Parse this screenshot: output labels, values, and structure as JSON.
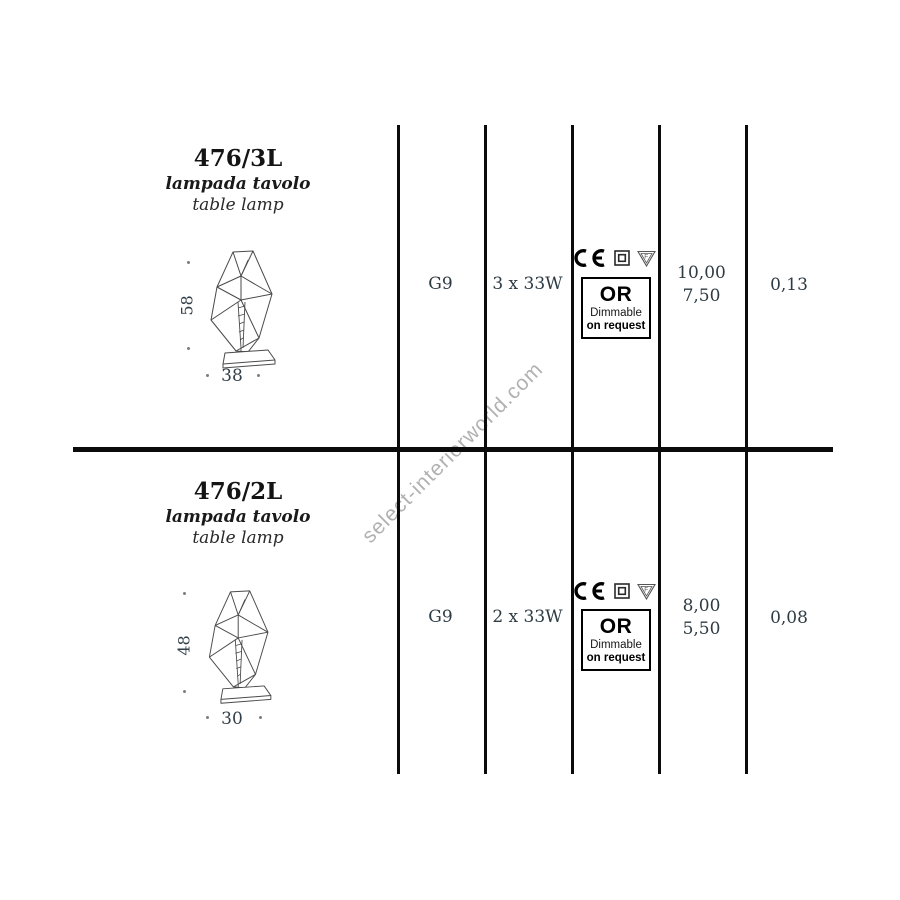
{
  "watermark": "select-interiorworld.com",
  "badges": {
    "or": "OR",
    "dimmable": "Dimmable",
    "on_request": "on request"
  },
  "icons": {
    "ce_mark": "CE",
    "double_insulation": "square-in-square",
    "f_mark": "F-in-triangle"
  },
  "rows": [
    {
      "code": "476/3L",
      "name_it": "lampada tavolo",
      "name_en": "table lamp",
      "height_cm": "58",
      "width_cm": "38",
      "socket": "G9",
      "wattage": "3 x 33W",
      "value_top": "10,00",
      "value_bottom": "7,50",
      "value_last": "0,13"
    },
    {
      "code": "476/2L",
      "name_it": "lampada tavolo",
      "name_en": "table lamp",
      "height_cm": "48",
      "width_cm": "30",
      "socket": "G9",
      "wattage": "2 x 33W",
      "value_top": "8,00",
      "value_bottom": "5,50",
      "value_last": "0,08"
    }
  ]
}
